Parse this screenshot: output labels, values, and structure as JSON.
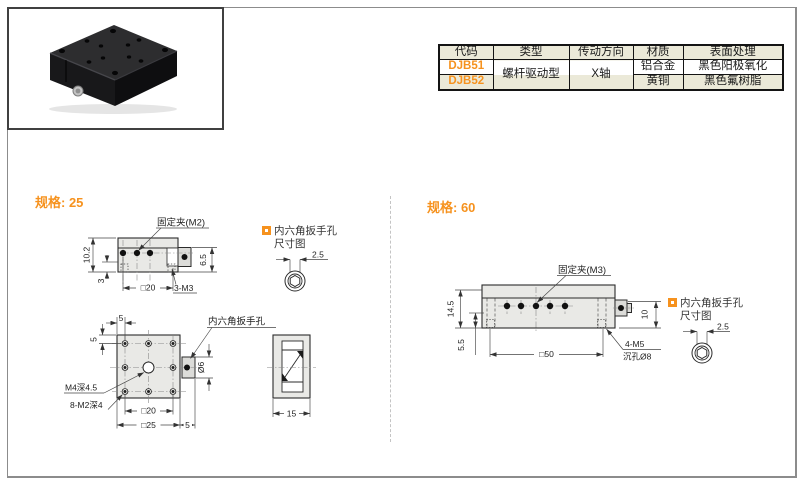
{
  "product_table": {
    "headers": {
      "code": "代码",
      "type": "类型",
      "direction": "传动方向",
      "material": "材质",
      "finish": "表面处理"
    },
    "shared": {
      "type": "螺杆驱动型",
      "direction": "X轴"
    },
    "rows": [
      {
        "code": "DJB51",
        "material": "铝合金",
        "finish": "黑色阳极氧化"
      },
      {
        "code": "DJB52",
        "material": "黄铜",
        "finish": "黑色氟树脂"
      }
    ]
  },
  "spec25": {
    "heading": "规格: 25",
    "side_view": {
      "clamp_label": "固定夹(M2)",
      "height": "10.2",
      "offset": "3",
      "width": "□20",
      "thread": "3-M3",
      "right_height": "6.5"
    },
    "plan_view": {
      "pitch_top": "5",
      "pitch_left": "5",
      "hex_label": "内六角扳手孔",
      "center_thread": "M4深4.5",
      "corner_threads": "8-M2深4",
      "inner_square": "□20",
      "outer_square": "□25",
      "knob_offset": "5",
      "knob_dia": "Ø6"
    },
    "profile_view": {
      "depth": "15"
    },
    "hex_detail": {
      "line1": "内六角扳手孔",
      "line2": "尺寸图",
      "dim": "2.5"
    }
  },
  "spec60": {
    "heading": "规格: 60",
    "side_view": {
      "clamp_label": "固定夹(M3)",
      "height": "14.5",
      "offset": "5.5",
      "width": "□50",
      "knob_height": "10",
      "thread_line1": "4-M5",
      "thread_line2": "沉孔Ø8"
    },
    "hex_detail": {
      "line1": "内六角扳手孔",
      "line2": "尺寸图",
      "dim": "2.5"
    }
  },
  "colors": {
    "accent_orange": "#f6921e",
    "table_header_bg": "#ebe9d8",
    "drawing_fill": "#e9e9e6"
  }
}
